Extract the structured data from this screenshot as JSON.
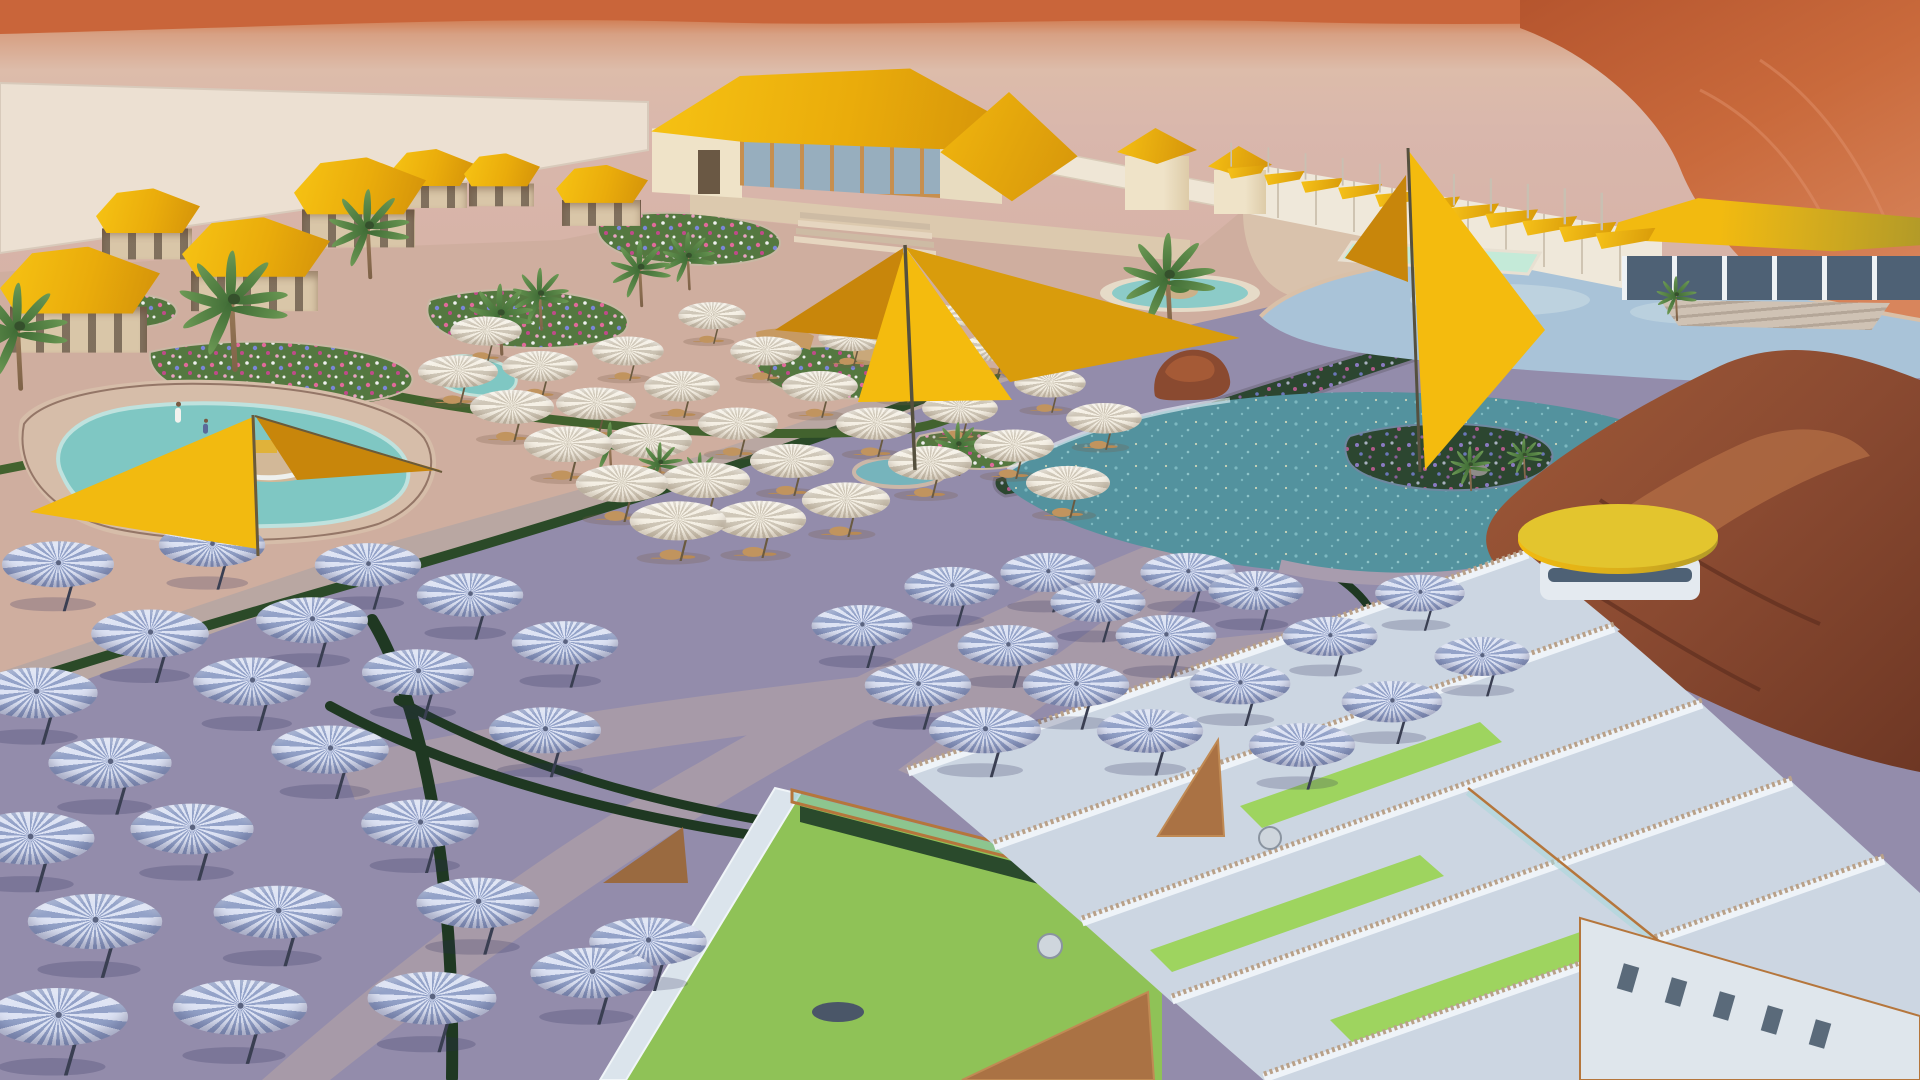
{
  "meta": {
    "title": "Desert resort aquapark — aerial 3D architectural rendering",
    "render_type": "architectural-visualization",
    "environment": "red desert dunes",
    "lighting": "low sun, long diagonal shadow across plaza",
    "visible_text": "none"
  },
  "palette": {
    "dune_orange": "#c9653a",
    "dune_deep": "#b5552e",
    "dune_light": "#d8855c",
    "sand_pink": "#d9b7ac",
    "pad_cream": "#ece0d2",
    "paving_lit": "#cfae9f",
    "paving_shadow": "#938cab",
    "path_shadow": "#a79aa8",
    "path_lit": "#bcaaa2",
    "hedge_lit": "#42622e",
    "hedge_shadow": "#1f3822",
    "roof_gold": "#f2b70e",
    "roof_gold_dark": "#d3920a",
    "roof_gold_olive": "#b29a28",
    "wall_cream": "#efe3c8",
    "wall_trim_orange": "#c78f4e",
    "pool_teal": "#7fc7c3",
    "pool_mint": "#c4ead8",
    "lagoon_light": "#a9c3d8",
    "lagoon_teal": "#53929e",
    "umbrella_shadow_rib": "#93a2c8",
    "umbrella_shadow_light": "#dde3f4",
    "umbrella_lit_rib": "#cfc7b8",
    "umbrella_lit_light": "#f5f0e5",
    "court_green": "#8fc257",
    "court_green_bright": "#9ed45f",
    "wall_white": "#dfe6ee",
    "corten_wood": "#aa7244",
    "rock_red": "#8a4a31",
    "stone_terrace": "#dcc9ae",
    "wood_tan": "#c79a62"
  },
  "scene_elements": {
    "background": [
      "desert-dunes",
      "distant-sand",
      "cream-ground-pad"
    ],
    "buildings": [
      "main-reception-hall",
      "cabana-row",
      "kiosk-towers",
      "changing-cabins-row",
      "lakeside-pavilion",
      "round-bar-canopy",
      "court-complex",
      "balcony-facade"
    ],
    "water": [
      "left-free-form-pool",
      "cafe-splash-pool",
      "circular-fountain",
      "lap-pool",
      "upper-lagoon",
      "lower-lagoon-with-island"
    ],
    "landscape": [
      "flower-beds",
      "garden-median",
      "hedge-ribbons",
      "palm-trees",
      "red-rock-outcrop"
    ],
    "furniture": [
      "shade-sails",
      "cantilever-umbrellas",
      "cafe-parasols",
      "table-sets"
    ]
  },
  "counts": {
    "shade_umbrellas_in_shadow": 42,
    "cafe_parasols_lit": 30,
    "palm_trees": 16,
    "cabanas": 7,
    "cabin_awnings": 11,
    "people": 2
  },
  "instances": {
    "groups": [
      {
        "template": "tpl-umb-s",
        "name": "shade-umbrella",
        "items": [
          [
            58,
            582,
            1
          ],
          [
            212,
            562,
            0.95
          ],
          [
            368,
            582,
            0.95
          ],
          [
            150,
            652,
            1.05
          ],
          [
            312,
            638,
            1
          ],
          [
            470,
            612,
            0.95
          ],
          [
            36,
            712,
            1.1
          ],
          [
            252,
            700,
            1.05
          ],
          [
            418,
            690,
            1
          ],
          [
            565,
            660,
            0.95
          ],
          [
            110,
            782,
            1.1
          ],
          [
            330,
            768,
            1.05
          ],
          [
            545,
            748,
            1
          ],
          [
            30,
            858,
            1.15
          ],
          [
            192,
            848,
            1.1
          ],
          [
            420,
            842,
            1.05
          ],
          [
            95,
            942,
            1.2
          ],
          [
            278,
            932,
            1.15
          ],
          [
            478,
            922,
            1.1
          ],
          [
            58,
            1038,
            1.25
          ],
          [
            240,
            1028,
            1.2
          ],
          [
            432,
            1018,
            1.15
          ],
          [
            592,
            992,
            1.1
          ],
          [
            648,
            960,
            1.05
          ],
          [
            862,
            642,
            0.9
          ],
          [
            952,
            602,
            0.85
          ],
          [
            918,
            702,
            0.95
          ],
          [
            1008,
            662,
            0.9
          ],
          [
            1098,
            618,
            0.85
          ],
          [
            1188,
            588,
            0.85
          ],
          [
            1048,
            588,
            0.85
          ],
          [
            985,
            748,
            1
          ],
          [
            1076,
            702,
            0.95
          ],
          [
            1166,
            652,
            0.9
          ],
          [
            1256,
            606,
            0.85
          ],
          [
            1150,
            748,
            0.95
          ],
          [
            1240,
            700,
            0.9
          ],
          [
            1330,
            652,
            0.85
          ],
          [
            1420,
            608,
            0.8
          ],
          [
            1302,
            762,
            0.95
          ],
          [
            1392,
            718,
            0.9
          ],
          [
            1482,
            672,
            0.85
          ]
        ]
      },
      {
        "template": "tpl-umb-l",
        "name": "cafe-parasol",
        "items": [
          [
            458,
            388,
            0.95
          ],
          [
            512,
            424,
            1
          ],
          [
            568,
            462,
            1.05
          ],
          [
            622,
            502,
            1.1
          ],
          [
            678,
            540,
            1.15
          ],
          [
            486,
            346,
            0.85
          ],
          [
            540,
            382,
            0.9
          ],
          [
            596,
            420,
            0.95
          ],
          [
            650,
            458,
            1
          ],
          [
            706,
            498,
            1.05
          ],
          [
            760,
            538,
            1.1
          ],
          [
            628,
            366,
            0.85
          ],
          [
            682,
            402,
            0.9
          ],
          [
            738,
            440,
            0.95
          ],
          [
            792,
            478,
            1
          ],
          [
            846,
            518,
            1.05
          ],
          [
            712,
            330,
            0.8
          ],
          [
            766,
            366,
            0.85
          ],
          [
            820,
            402,
            0.9
          ],
          [
            876,
            440,
            0.95
          ],
          [
            930,
            480,
            1
          ],
          [
            852,
            352,
            0.8
          ],
          [
            906,
            388,
            0.85
          ],
          [
            960,
            424,
            0.9
          ],
          [
            1014,
            462,
            0.95
          ],
          [
            996,
            362,
            0.8
          ],
          [
            1050,
            398,
            0.85
          ],
          [
            938,
            332,
            0.78
          ],
          [
            1068,
            500,
            1
          ],
          [
            1104,
            434,
            0.9
          ]
        ]
      },
      {
        "template": "tpl-palm",
        "name": "palm-tree",
        "items": [
          [
            18,
            338,
            1.2
          ],
          [
            92,
            306,
            0.85
          ],
          [
            232,
            312,
            1.35
          ],
          [
            368,
            236,
            1
          ],
          [
            500,
            322,
            0.8
          ],
          [
            540,
            302,
            0.7
          ],
          [
            640,
            276,
            0.75
          ],
          [
            688,
            264,
            0.65
          ],
          [
            610,
            452,
            0.6
          ],
          [
            660,
            470,
            0.55
          ],
          [
            700,
            478,
            0.5
          ],
          [
            958,
            452,
            0.6
          ],
          [
            1168,
            286,
            1.15
          ],
          [
            1470,
            472,
            0.5
          ],
          [
            1524,
            462,
            0.45
          ],
          [
            1676,
            302,
            0.5
          ]
        ]
      },
      {
        "template": "tpl-cabana",
        "name": "cabana-bungalow",
        "items": [
          [
            80,
            306,
            1,
            160,
            108
          ],
          [
            148,
            228,
            1,
            104,
            72
          ],
          [
            256,
            270,
            1,
            148,
            96
          ],
          [
            360,
            208,
            1,
            132,
            92
          ],
          [
            432,
            182,
            1,
            84,
            60
          ],
          [
            502,
            183,
            1,
            76,
            54
          ],
          [
            602,
            199,
            1,
            92,
            62
          ]
        ]
      },
      {
        "template": "tpl-awn",
        "name": "cabin-awning",
        "items": [
          [
            1248,
            170,
            0.8
          ],
          [
            1286,
            176,
            0.84
          ],
          [
            1324,
            183,
            0.88
          ],
          [
            1362,
            189,
            0.92
          ],
          [
            1400,
            196,
            0.96
          ],
          [
            1438,
            202,
            1
          ],
          [
            1476,
            209,
            1.05
          ],
          [
            1514,
            215,
            1.1
          ],
          [
            1552,
            222,
            1.15
          ],
          [
            1590,
            228,
            1.2
          ],
          [
            1628,
            234,
            1.25
          ]
        ]
      },
      {
        "template": "tpl-person",
        "name": "visitor",
        "items": [
          [
            178,
            414,
            1
          ],
          [
            206,
            426,
            1
          ]
        ]
      }
    ]
  }
}
